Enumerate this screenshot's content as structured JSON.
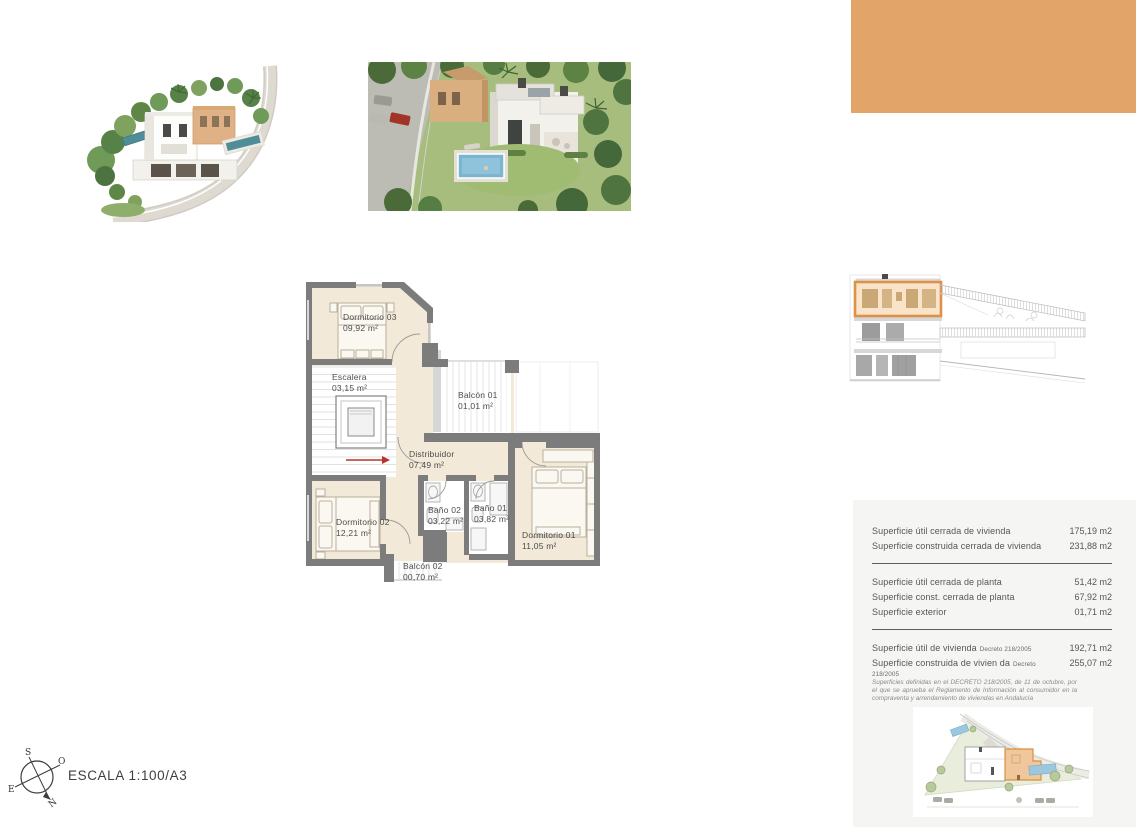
{
  "document": {
    "scale_label": "ESCALA 1:100/A3"
  },
  "accent": {
    "color": "#E2A469"
  },
  "compass": {
    "north": "N",
    "south": "S",
    "east": "E",
    "west": "O"
  },
  "floor_plan": {
    "rooms": [
      {
        "name": "Dormitorio 03",
        "area": "09,92 m²"
      },
      {
        "name": "Escalera",
        "area": "03,15 m²"
      },
      {
        "name": "Balcón 01",
        "area": "01,01 m²"
      },
      {
        "name": "Distribuidor",
        "area": "07,49 m²"
      },
      {
        "name": "Baño 02",
        "area": "03,22 m²"
      },
      {
        "name": "Baño 01",
        "area": "03,82 m²"
      },
      {
        "name": "Dormitorio 02",
        "area": "12,21 m²"
      },
      {
        "name": "Dormitorio 01",
        "area": "11,05 m²"
      },
      {
        "name": "Balcón 02",
        "area": "00,70 m²"
      }
    ]
  },
  "surface_table": {
    "rows": [
      {
        "label": "Superficie útil cerrada de vivienda",
        "note": "",
        "value": "175,19 m2"
      },
      {
        "label": "Superficie construida cerrada de vivienda",
        "note": "",
        "value": "231,88 m2"
      },
      {
        "label": "Superficie útil cerrada de planta",
        "note": "",
        "value": "51,42 m2"
      },
      {
        "label": "Superficie const. cerrada de planta",
        "note": "",
        "value": "67,92 m2"
      },
      {
        "label": "Superficie exterior",
        "note": "",
        "value": "01,71 m2"
      },
      {
        "label": "Superficie útil de vivienda",
        "note": "Decreto 218/2005",
        "value": "192,71 m2"
      },
      {
        "label": "Superficie construida de vivien da",
        "note": "Decreto 218/2005",
        "value": "255,07 m2"
      }
    ],
    "footnote": "Superficies definidas en el DECRETO 218/2005, de 11 de octubre, por el que se aprueba el Reglamento de Información al consumidor en la compraventa y arrendamiento de viviendas en Andalucía"
  }
}
